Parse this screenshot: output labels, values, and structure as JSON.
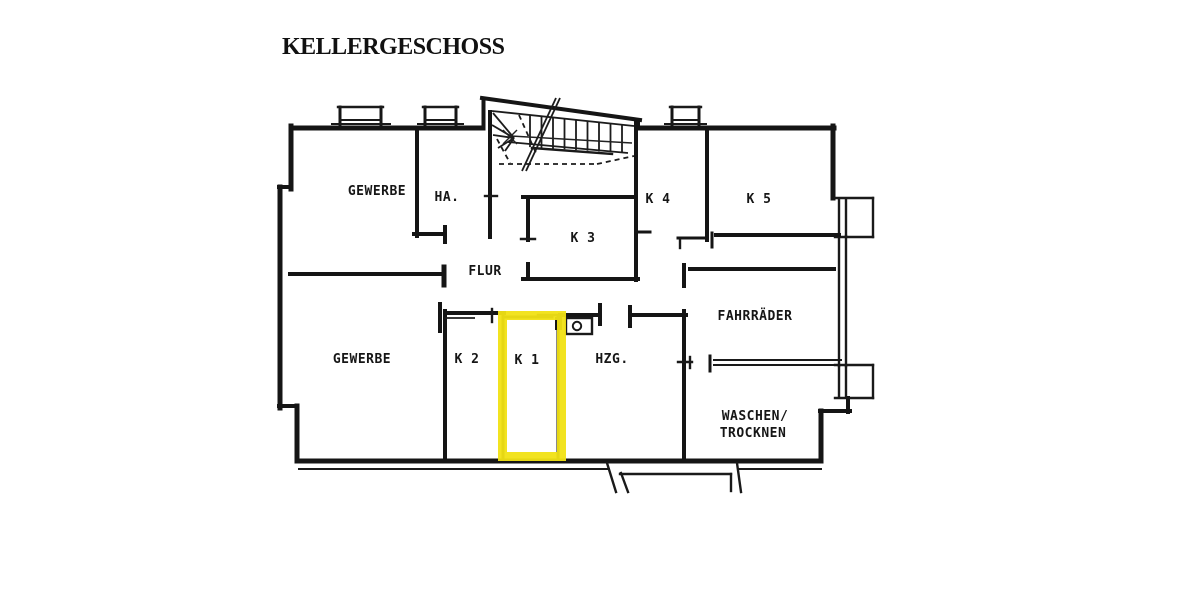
{
  "title": "KELLERGESCHOSS",
  "floorplan": {
    "background_color": "#ffffff",
    "line_color": "#151515",
    "highlight_color": "#f1e214",
    "highlighted_room": "K 1",
    "rooms": [
      {
        "label": "GEWERBE"
      },
      {
        "label": "HA."
      },
      {
        "label": "K 3"
      },
      {
        "label": "K 4"
      },
      {
        "label": "K 5"
      },
      {
        "label": "FLUR"
      },
      {
        "label": "GEWERBE"
      },
      {
        "label": "K 2"
      },
      {
        "label": "K 1"
      },
      {
        "label": "HZG."
      },
      {
        "label": "FAHRRÄDER"
      },
      {
        "label": "WASCHEN/"
      },
      {
        "label": "TROCKNEN"
      }
    ]
  }
}
